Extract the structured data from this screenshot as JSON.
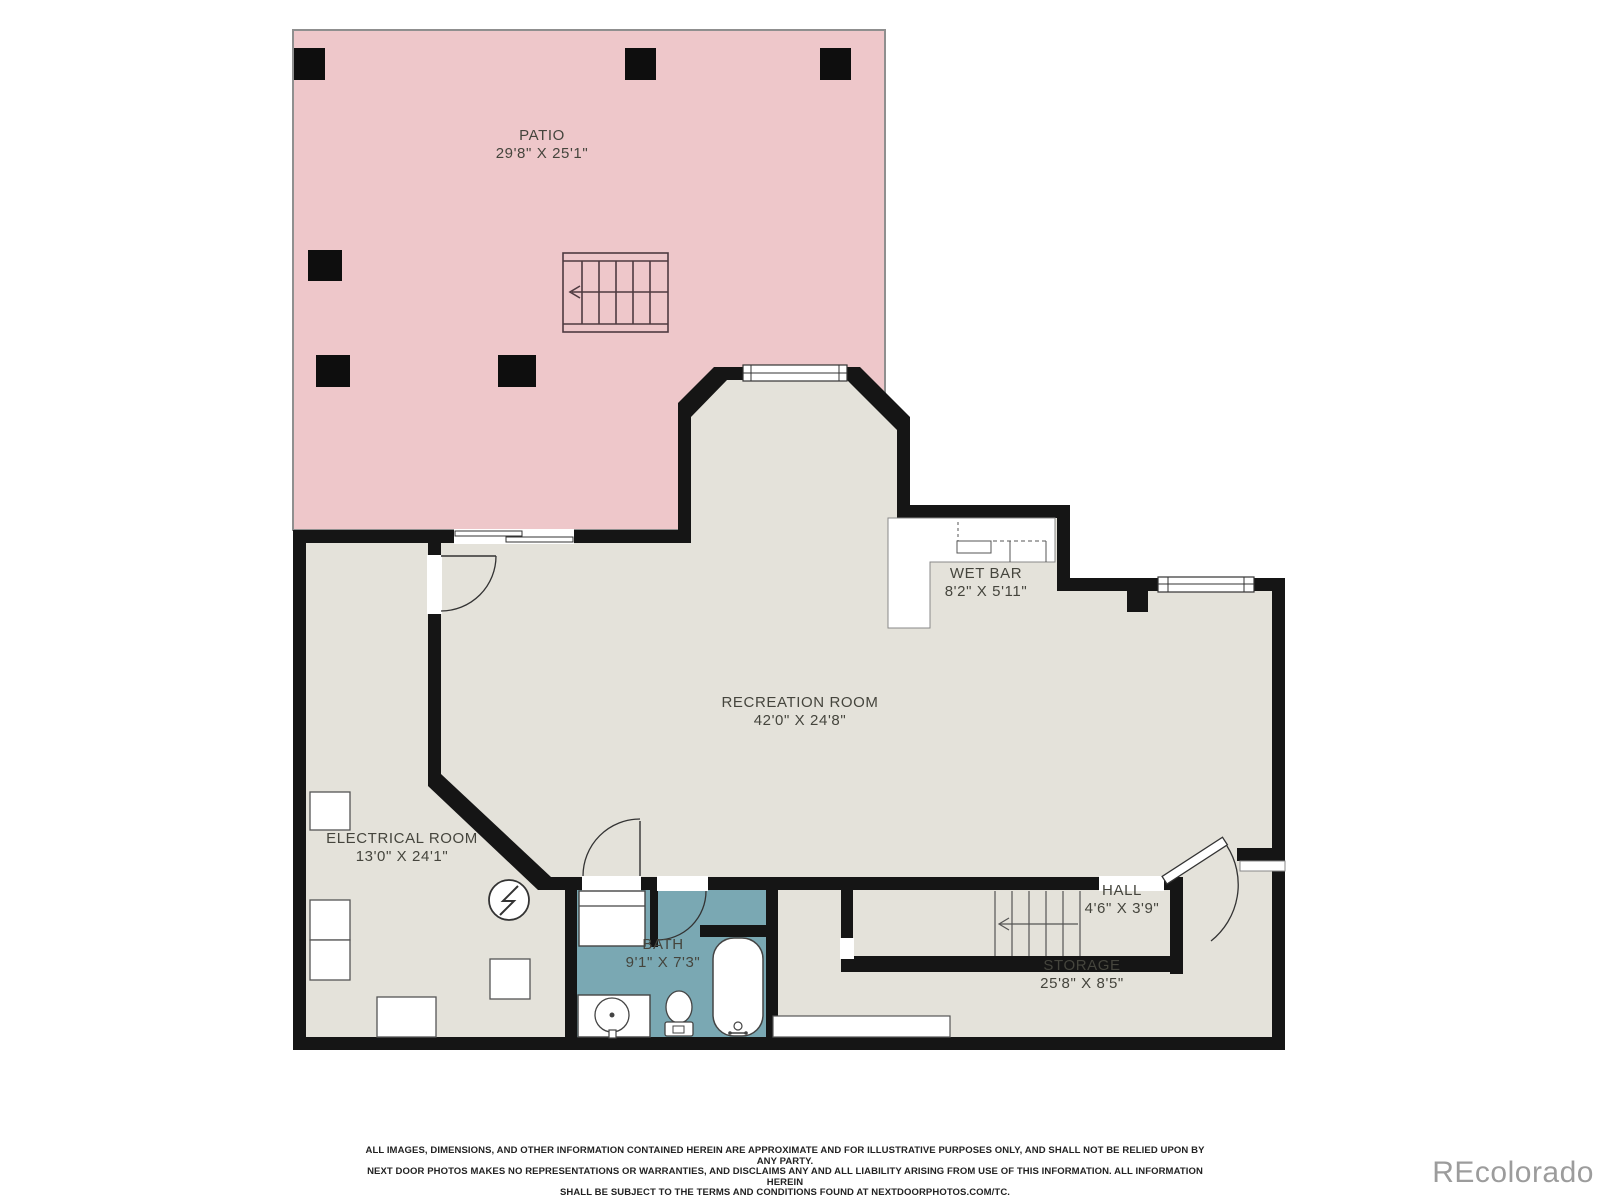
{
  "floorplan": {
    "rooms": [
      {
        "name": "PATIO",
        "dims": "29'8\" X 25'1\""
      },
      {
        "name": "WET BAR",
        "dims": "8'2\" X 5'11\""
      },
      {
        "name": "RECREATION ROOM",
        "dims": "42'0\" X 24'8\""
      },
      {
        "name": "ELECTRICAL ROOM",
        "dims": "13'0\" X 24'1\""
      },
      {
        "name": "BATH",
        "dims": "9'1\" X 7'3\""
      },
      {
        "name": "HALL",
        "dims": "4'6\" X 3'9\""
      },
      {
        "name": "STORAGE",
        "dims": "25'8\" X 8'5\""
      }
    ],
    "colors": {
      "patio": "#eec7ca",
      "interior": "#e4e2da",
      "bath": "#7aa8b3",
      "wall": "#151515"
    },
    "disclaimer": {
      "line1": "ALL IMAGES, DIMENSIONS, AND OTHER INFORMATION CONTAINED HEREIN ARE APPROXIMATE AND FOR ILLUSTRATIVE PURPOSES ONLY, AND SHALL NOT BE RELIED UPON BY ANY PARTY.",
      "line2": "NEXT DOOR PHOTOS MAKES NO REPRESENTATIONS OR WARRANTIES, AND DISCLAIMS ANY AND ALL LIABILITY ARISING FROM USE OF THIS INFORMATION. ALL INFORMATION HEREIN",
      "line3": "SHALL BE SUBJECT TO THE TERMS AND CONDITIONS FOUND AT NEXTDOORPHOTOS.COM/TC."
    },
    "watermark": "REcolorado"
  }
}
